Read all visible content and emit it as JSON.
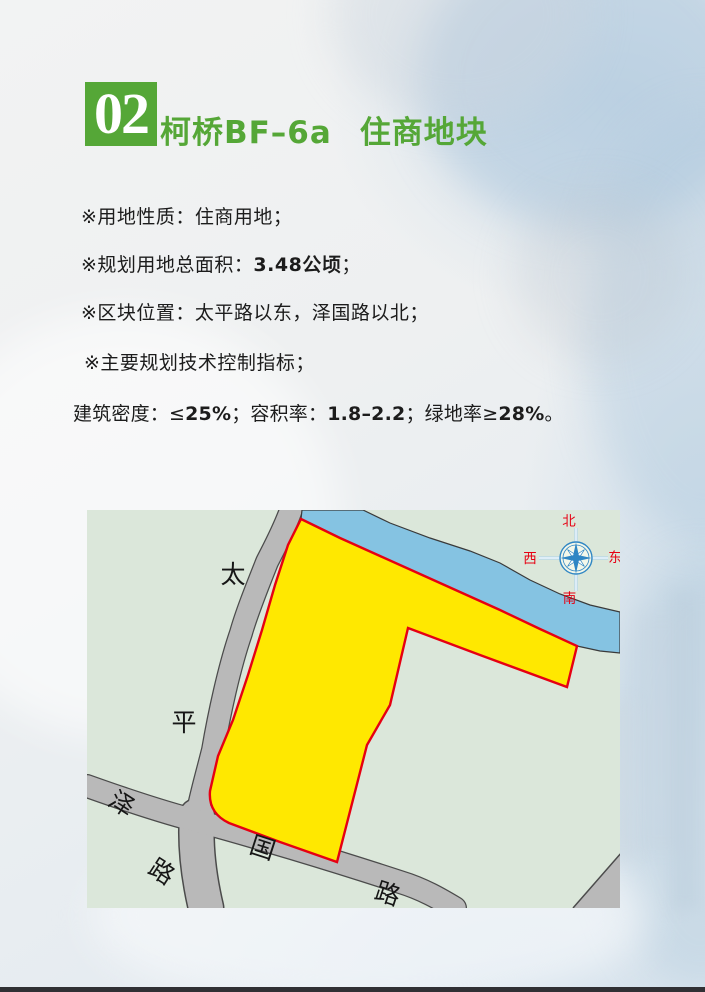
{
  "page": {
    "badge_number": "02",
    "title_code": "柯桥BF–6a",
    "title_name": "住商地块"
  },
  "info": {
    "line1": {
      "text": "※用地性质：住商用地；"
    },
    "line2": {
      "pre": "※规划用地总面积：",
      "bold": "3.48公顷",
      "post": "；"
    },
    "line3": {
      "text": "※区块位置：太平路以东，泽国路以北；"
    },
    "line4": {
      "text": "※主要规划技术控制指标；"
    },
    "line5": {
      "s1": "建筑密度：≤",
      "b1": "25%",
      "s2": "；容积率：",
      "b2": "1.8–2.2",
      "s3": "；绿地率≥",
      "b3": "28%",
      "s4": "。"
    }
  },
  "map": {
    "road_taiping": [
      "太",
      "平",
      "路"
    ],
    "road_zeguo": [
      "泽",
      "国",
      "路"
    ],
    "compass": {
      "north": "北",
      "south": "南",
      "west": "西",
      "east": "东"
    },
    "colors": {
      "accent_green": "#55a737",
      "map_background": "#dbe7da",
      "parcel_fill": "#ffe800",
      "parcel_border": "#e60012",
      "river": "#85c3e2",
      "road": "#b9b9b9",
      "compass_blue": "#2f86c4",
      "compass_label_red": "#e60012"
    }
  }
}
